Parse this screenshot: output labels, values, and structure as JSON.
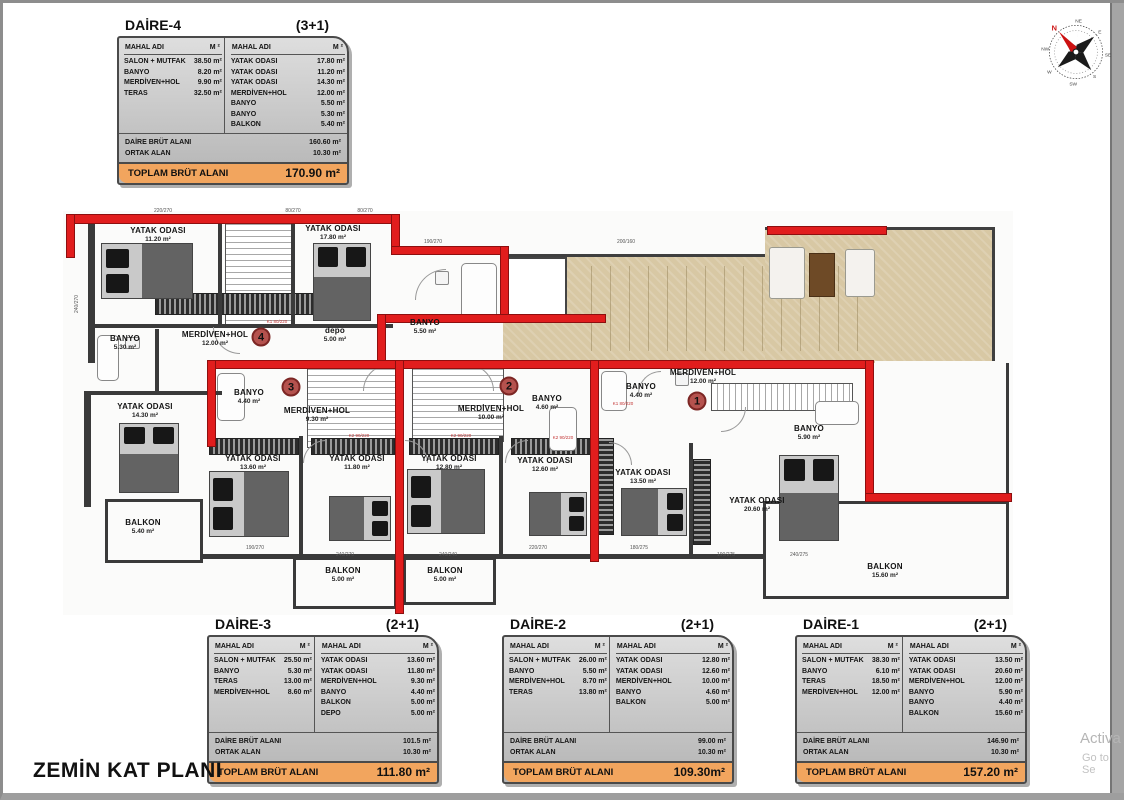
{
  "title": "ZEMİN KAT PLANI",
  "watermark": {
    "line1": "Activa",
    "line2": "Go to Se"
  },
  "colors": {
    "wall_red": "#e11d1d",
    "accent_orange": "#f2a55e",
    "terrace_beige": "#d8c8a4",
    "table_gray": "#c9c9c9"
  },
  "compass": {
    "labels": [
      "N",
      "NE",
      "E",
      "SE",
      "S",
      "SW",
      "W",
      "NW"
    ]
  },
  "tables": {
    "daire4": {
      "title": "DAİRE-4",
      "type": "(3+1)",
      "col_name": "MAHAL ADI",
      "col_unit": "M ²",
      "left_rows": [
        {
          "name": "SALON + MUTFAK",
          "value": "38.50 m²"
        },
        {
          "name": "BANYO",
          "value": "8.20 m²"
        },
        {
          "name": "MERDİVEN+HOL",
          "value": "9.90 m²"
        },
        {
          "name": "TERAS",
          "value": "32.50 m²"
        }
      ],
      "right_rows": [
        {
          "name": "YATAK ODASI",
          "value": "17.80 m²"
        },
        {
          "name": "YATAK ODASI",
          "value": "11.20 m²"
        },
        {
          "name": "YATAK ODASI",
          "value": "14.30 m²"
        },
        {
          "name": "MERDİVEN+HOL",
          "value": "12.00 m²"
        },
        {
          "name": "BANYO",
          "value": "5.50 m²"
        },
        {
          "name": "BANYO",
          "value": "5.30 m²"
        },
        {
          "name": "BALKON",
          "value": "5.40 m²"
        }
      ],
      "brut_label": "DAİRE BRÜT ALANI",
      "brut_value": "160.60 m²",
      "ortak_label": "ORTAK ALAN",
      "ortak_value": "10.30 m²",
      "toplam_label": "TOPLAM BRÜT ALANI",
      "toplam_value": "170.90 m²"
    },
    "daire3": {
      "title": "DAİRE-3",
      "type": "(2+1)",
      "col_name": "MAHAL ADI",
      "col_unit": "M ²",
      "left_rows": [
        {
          "name": "SALON + MUTFAK",
          "value": "25.50 m²"
        },
        {
          "name": "BANYO",
          "value": "5.30 m²"
        },
        {
          "name": "TERAS",
          "value": "13.00 m²"
        },
        {
          "name": "MERDİVEN+HOL",
          "value": "8.60 m²"
        }
      ],
      "right_rows": [
        {
          "name": "YATAK ODASI",
          "value": "13.60 m²"
        },
        {
          "name": "YATAK ODASI",
          "value": "11.80 m²"
        },
        {
          "name": "MERDİVEN+HOL",
          "value": "9.30 m²"
        },
        {
          "name": "BANYO",
          "value": "4.40 m²"
        },
        {
          "name": "BALKON",
          "value": "5.00 m²"
        },
        {
          "name": "DEPO",
          "value": "5.00 m²"
        }
      ],
      "brut_label": "DAİRE BRÜT ALANI",
      "brut_value": "101.5 m²",
      "ortak_label": "ORTAK ALAN",
      "ortak_value": "10.30 m²",
      "toplam_label": "TOPLAM BRÜT ALANI",
      "toplam_value": "111.80 m²"
    },
    "daire2": {
      "title": "DAİRE-2",
      "type": "(2+1)",
      "col_name": "MAHAL ADI",
      "col_unit": "M ²",
      "left_rows": [
        {
          "name": "SALON + MUTFAK",
          "value": "26.00 m²"
        },
        {
          "name": "BANYO",
          "value": "5.50 m²"
        },
        {
          "name": "MERDİVEN+HOL",
          "value": "8.70 m²"
        },
        {
          "name": "TERAS",
          "value": "13.80 m²"
        }
      ],
      "right_rows": [
        {
          "name": "YATAK ODASI",
          "value": "12.80 m²"
        },
        {
          "name": "YATAK ODASI",
          "value": "12.60 m²"
        },
        {
          "name": "MERDİVEN+HOL",
          "value": "10.00 m²"
        },
        {
          "name": "BANYO",
          "value": "4.60 m²"
        },
        {
          "name": "BALKON",
          "value": "5.00 m²"
        }
      ],
      "brut_label": "DAİRE BRÜT ALANI",
      "brut_value": "99.00 m²",
      "ortak_label": "ORTAK ALAN",
      "ortak_value": "10.30 m²",
      "toplam_label": "TOPLAM BRÜT ALANI",
      "toplam_value": "109.30m²"
    },
    "daire1": {
      "title": "DAİRE-1",
      "type": "(2+1)",
      "col_name": "MAHAL ADI",
      "col_unit": "M ²",
      "left_rows": [
        {
          "name": "SALON + MUTFAK",
          "value": "38.30 m²"
        },
        {
          "name": "BANYO",
          "value": "6.10 m²"
        },
        {
          "name": "TERAS",
          "value": "18.50 m²"
        },
        {
          "name": "MERDİVEN+HOL",
          "value": "12.00 m²"
        }
      ],
      "right_rows": [
        {
          "name": "YATAK ODASI",
          "value": "13.50 m²"
        },
        {
          "name": "YATAK ODASI",
          "value": "20.60 m²"
        },
        {
          "name": "MERDİVEN+HOL",
          "value": "12.00 m²"
        },
        {
          "name": "BANYO",
          "value": "5.90 m²"
        },
        {
          "name": "BANYO",
          "value": "4.40 m²"
        },
        {
          "name": "BALKON",
          "value": "15.60 m²"
        }
      ],
      "brut_label": "DAİRE BRÜT ALANI",
      "brut_value": "146.90 m²",
      "ortak_label": "ORTAK ALAN",
      "ortak_value": "10.30 m²",
      "toplam_label": "TOPLAM BRÜT ALANI",
      "toplam_value": "157.20 m²"
    }
  },
  "plan": {
    "rooms": [
      {
        "name": "YATAK ODASI",
        "area": "11.20 m²"
      },
      {
        "name": "YATAK ODASI",
        "area": "17.80 m²"
      },
      {
        "name": "BANYO",
        "area": "5.30 m²"
      },
      {
        "name": "MERDİVEN+HOL",
        "area": "12.00 m²"
      },
      {
        "name": "depo",
        "area": "5.00 m²"
      },
      {
        "name": "BANYO",
        "area": "5.50 m²"
      },
      {
        "name": "YATAK ODASI",
        "area": "14.30 m²"
      },
      {
        "name": "BALKON",
        "area": "5.40 m²"
      },
      {
        "name": "BANYO",
        "area": "4.40 m²"
      },
      {
        "name": "MERDİVEN+HOL",
        "area": "9.30 m²"
      },
      {
        "name": "MERDİVEN+HOL",
        "area": "10.00 m²"
      },
      {
        "name": "BANYO",
        "area": "4.60 m²"
      },
      {
        "name": "BANYO",
        "area": "4.40 m²"
      },
      {
        "name": "MERDİVEN+HOL",
        "area": "12.00 m²"
      },
      {
        "name": "BANYO",
        "area": "5.90 m²"
      },
      {
        "name": "YATAK ODASI",
        "area": "13.60 m²"
      },
      {
        "name": "YATAK ODASI",
        "area": "11.80 m²"
      },
      {
        "name": "YATAK ODASI",
        "area": "12.80 m²"
      },
      {
        "name": "YATAK ODASI",
        "area": "12.60 m²"
      },
      {
        "name": "YATAK ODASI",
        "area": "13.50 m²"
      },
      {
        "name": "YATAK ODASI",
        "area": "20.60 m²"
      },
      {
        "name": "BALKON",
        "area": "5.00 m²"
      },
      {
        "name": "BALKON",
        "area": "5.00 m²"
      },
      {
        "name": "BALKON",
        "area": "15.60 m²"
      }
    ],
    "units": [
      {
        "number": "4"
      },
      {
        "number": "3"
      },
      {
        "number": "2"
      },
      {
        "number": "1"
      }
    ],
    "dims": [
      "220/270",
      "80/270",
      "80/270",
      "190/270",
      "200/160",
      "190/270",
      "240/270",
      "240/240",
      "220/270",
      "180/275",
      "190/275",
      "240/275",
      "240/270"
    ],
    "door_labels": {
      "k1": "K1 80/220",
      "k2": "K2 90/220"
    }
  }
}
